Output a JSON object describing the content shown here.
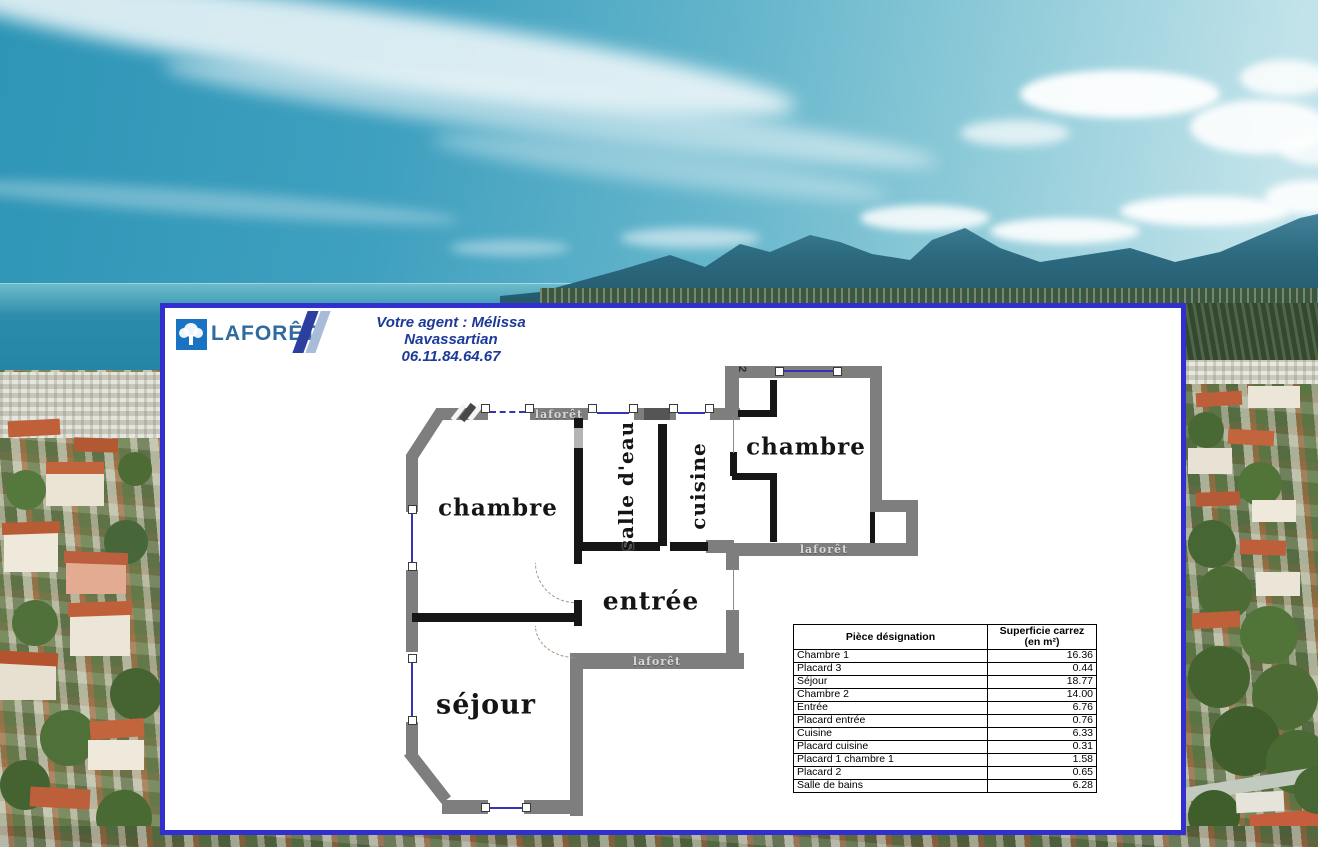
{
  "page": {
    "width": 1318,
    "height": 847
  },
  "brand": {
    "name": "LAFORÊT",
    "logo_square_color": "#1a73c2",
    "wordmark_color": "#2f6b9f",
    "stripe_dark": "#2c3f9e",
    "stripe_light": "#a8bcd9"
  },
  "agent": {
    "intro": "Votre agent : Mélissa Navassartian",
    "phone": "06.11.84.64.67",
    "text_color": "#1d3a99"
  },
  "panel": {
    "border_color": "#3130cf",
    "background_color": "#ffffff"
  },
  "floorplan": {
    "wall_outer_color": "#7e7e7e",
    "wall_inner_color": "#161616",
    "window_color": "#3434b4",
    "watermark": "laforêt",
    "closet_number": "2",
    "rooms": [
      {
        "id": "chambre-1",
        "label": "chambre"
      },
      {
        "id": "salle-d-eau",
        "label": "salle d'eau"
      },
      {
        "id": "cuisine",
        "label": "cuisine"
      },
      {
        "id": "chambre-2",
        "label": "chambre"
      },
      {
        "id": "entree",
        "label": "entrée"
      },
      {
        "id": "sejour",
        "label": "séjour"
      }
    ]
  },
  "area_table": {
    "headers": [
      "Pièce désignation",
      "Superficie carrez (en m²)"
    ],
    "rows": [
      [
        "Chambre 1",
        "16.36"
      ],
      [
        "Placard 3",
        "0.44"
      ],
      [
        "Séjour",
        "18.77"
      ],
      [
        "Chambre 2",
        "14.00"
      ],
      [
        "Entrée",
        "6.76"
      ],
      [
        "Placard entrée",
        "0.76"
      ],
      [
        "Cuisine",
        "6.33"
      ],
      [
        "Placard cuisine",
        "0.31"
      ],
      [
        "Placard 1 chambre 1",
        "1.58"
      ],
      [
        "Placard 2",
        "0.65"
      ],
      [
        "Salle de bains",
        "6.28"
      ]
    ]
  }
}
